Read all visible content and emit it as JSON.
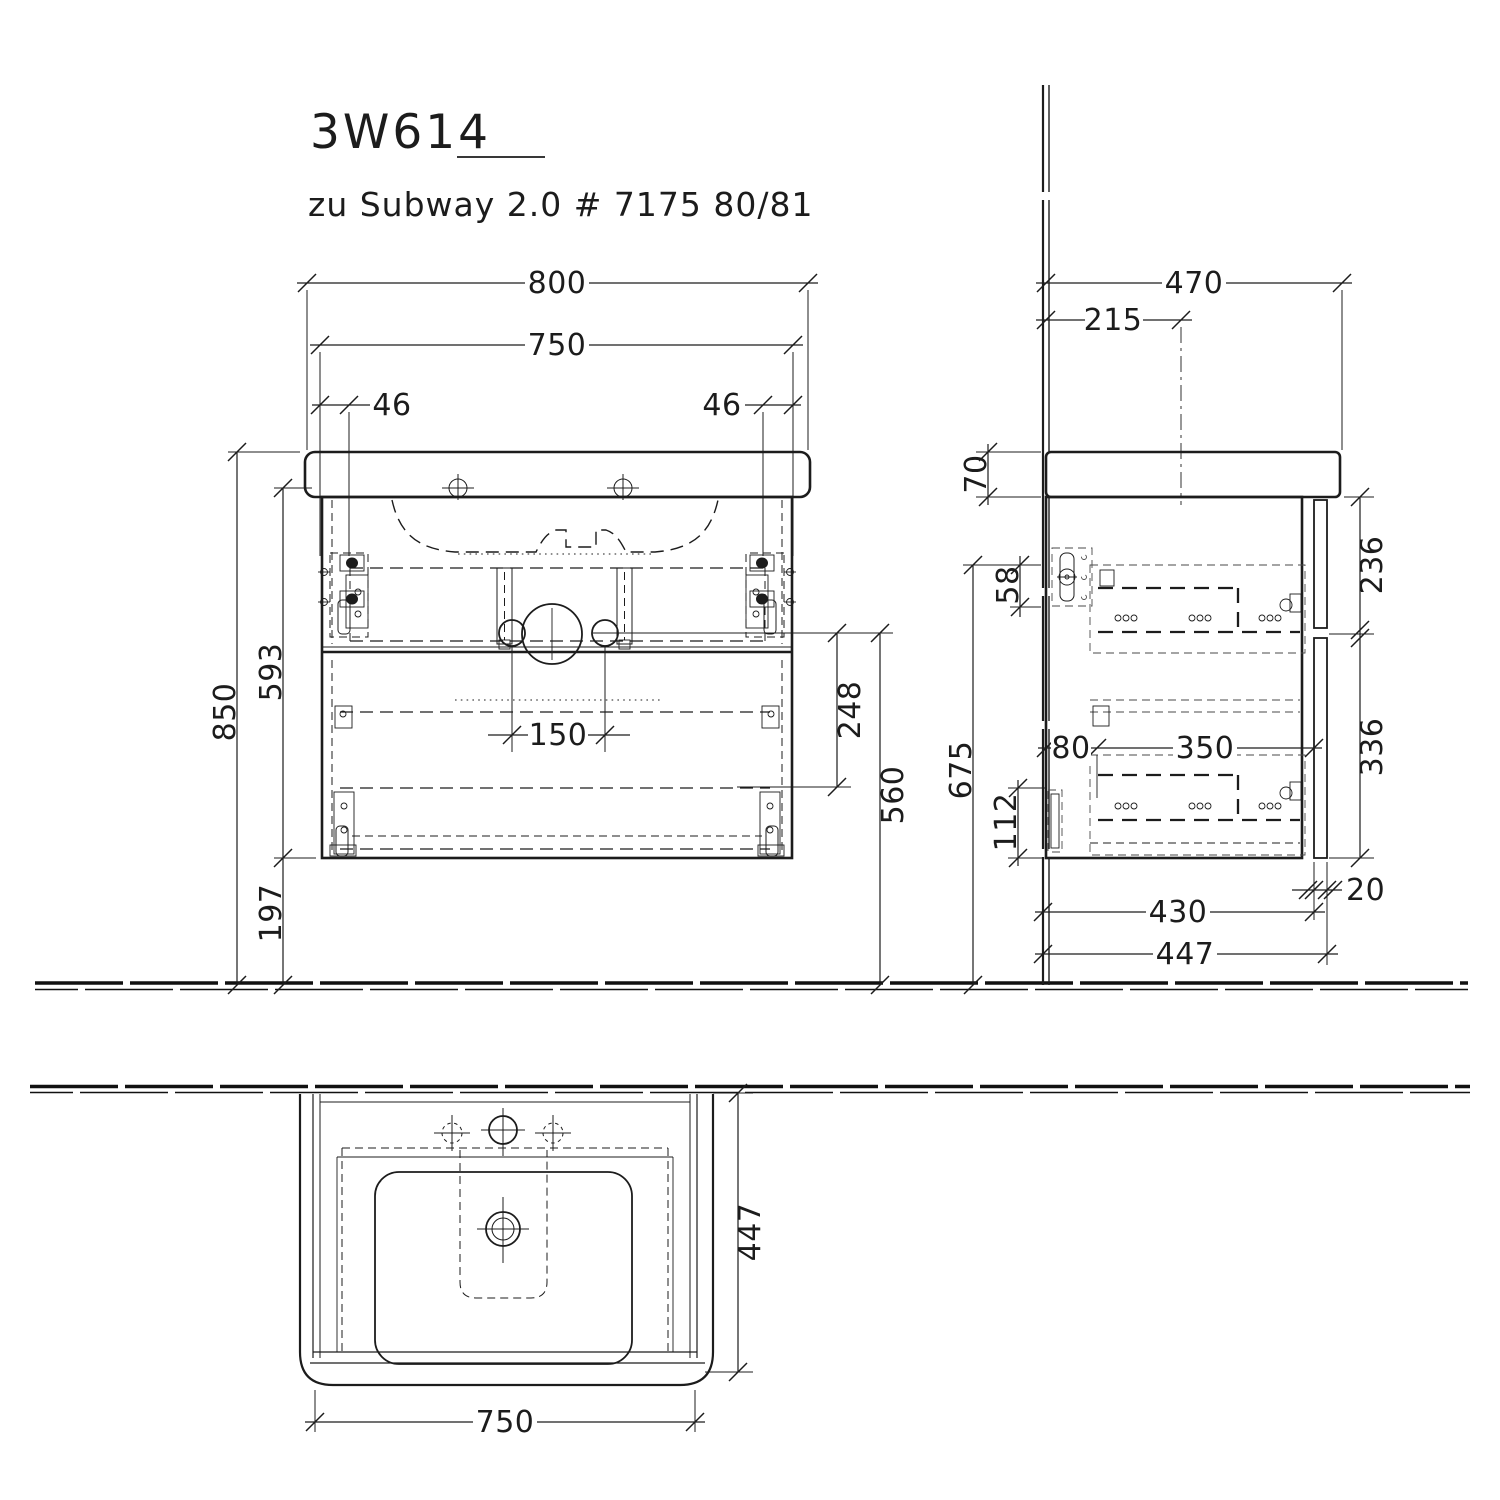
{
  "title": "3W614",
  "subtitle": "zu Subway 2.0 # 7175 80/81",
  "colors": {
    "line": "#1c1c1c",
    "background": "#ffffff"
  },
  "dims": {
    "front": {
      "basin_width": "800",
      "cabinet_width": "750",
      "bracket_offset_left": "46",
      "bracket_offset_right": "46",
      "total_height": "850",
      "cabinet_height": "593",
      "floor_clearance": "197",
      "drain_spacing": "150",
      "mount_drop": "248",
      "drain_height": "560"
    },
    "side": {
      "basin_depth": "470",
      "drain_center_depth": "215",
      "basin_thickness": "70",
      "bracket_height": "58",
      "wall_mount_height": "675",
      "lower_mount_height": "112",
      "rail_offset": "80",
      "rail_span": "350",
      "upper_front_height": "236",
      "lower_front_height": "336",
      "door_thickness": "20",
      "carcass_depth": "430",
      "total_depth": "447"
    },
    "plan": {
      "depth": "447",
      "width": "750"
    }
  }
}
